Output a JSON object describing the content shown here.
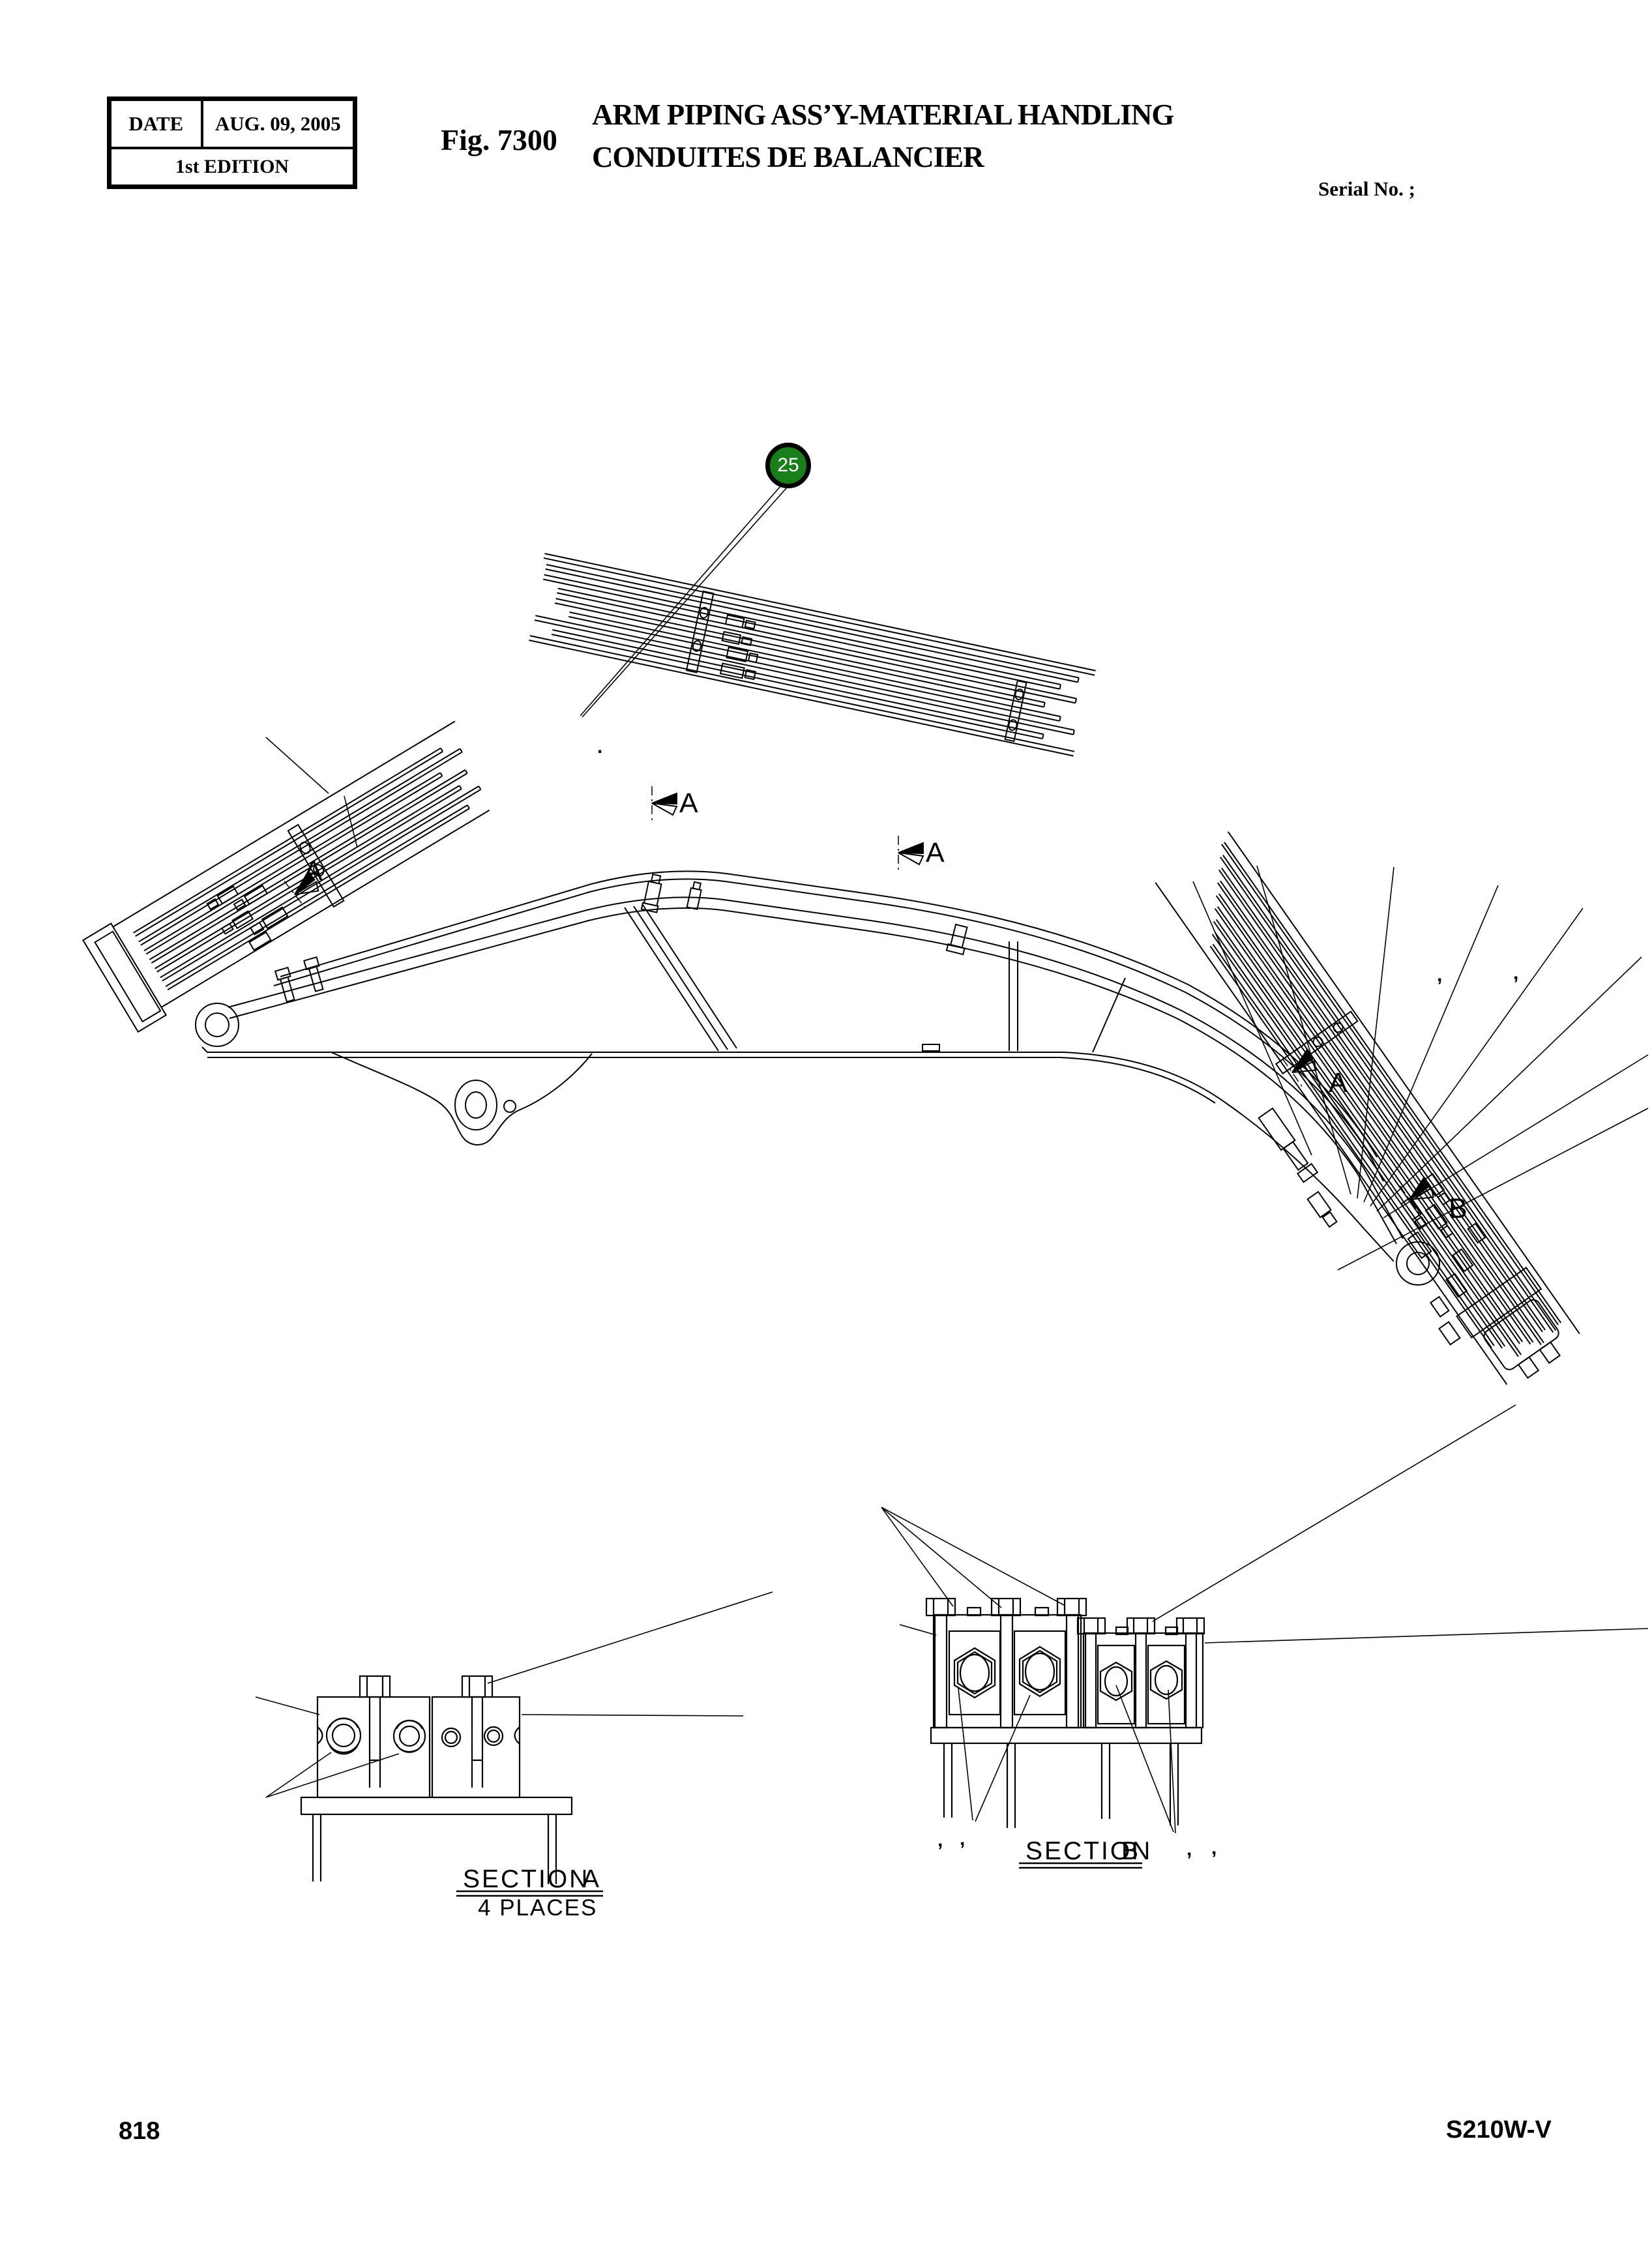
{
  "header": {
    "date_label": "DATE",
    "date_value": "AUG. 09, 2005",
    "edition": "1st EDITION",
    "fig_label": "Fig. 7300",
    "title_line1": "ARM PIPING ASS’Y-MATERIAL HANDLING",
    "title_line2": "CONDUITES DE BALANCIER",
    "serial_label": "Serial No. ;"
  },
  "footer": {
    "page_number": "818",
    "model_code": "S210W-V"
  },
  "balloon": {
    "number": "25",
    "fill": "#1a7e1a"
  },
  "sections": {
    "a": {
      "name": "SECTION",
      "letter": "A",
      "note": "4 PLACES"
    },
    "b": {
      "name": "SECTION",
      "letter": "B"
    }
  },
  "view_markers": [
    {
      "label": "A"
    },
    {
      "label": "A"
    },
    {
      "label": "A"
    },
    {
      "label": "A"
    },
    {
      "label": "B"
    }
  ],
  "stray_marks": {
    "dot_under_leader": ".",
    "comma_right_bundle_1": ",",
    "comma_right_bundle_2": ",",
    "comma_secb_left_1": ",",
    "comma_secb_left_2": ",",
    "comma_secb_right_1": ",",
    "comma_secb_right_2": ","
  }
}
